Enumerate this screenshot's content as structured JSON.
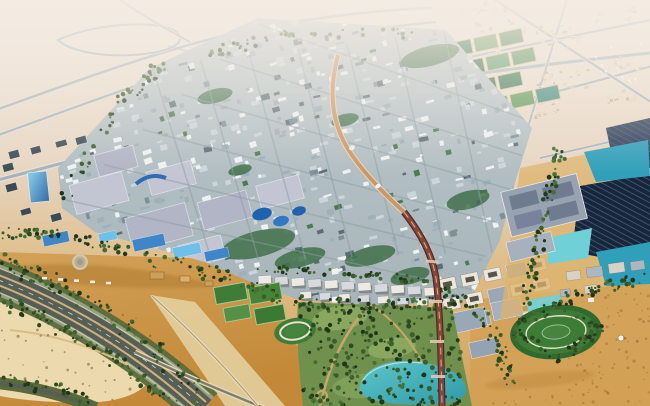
{
  "meta": {
    "description": "Aerial architectural rendering of a planned desert eco-city (Masdar-style masterplan) surrounded by sand, with a dense low-rise grid, a red elevated transit spine, solar farms, parks, sports fields, a lake and a curving tree-lined highway interchange.",
    "width": 650,
    "height": 406
  },
  "palette": {
    "haze_top": "#efe6dd",
    "sand_far": "#e7d5c0",
    "sand_mid": "#debb84",
    "sand_gold": "#d2a055",
    "sand_deep": "#c28736",
    "sand_pale_ring": "#ecd9ae",
    "sand_strip": "#e3cf9f",
    "dune_shadow": "#b07b31",
    "city_top": "#bdc9cd",
    "city_bottom": "#a7b4b9",
    "road_casing": "#eae3d8",
    "road_line": "#a6b3bc",
    "tree_band": "#5a6a3c",
    "verge": "#95a07e",
    "asphalt": "#575f55",
    "median_tan": "#cbb183",
    "lane_line": "#d9d9cb",
    "transit_upper": "#c9986a",
    "transit_upper_casing": "#ecd4ae",
    "transit_low_casing": "#4f2a22",
    "transit_low": "#86463a",
    "transit_center": "#dba57f",
    "bridge": "#dccab0",
    "solar_dark1": "#16263f",
    "solar_dark2": "#263c5f",
    "solar_patch": "#2c4366",
    "pond1": "#2f9fba",
    "pond2": "#6fd0d8",
    "lake1": "#2f9aa8",
    "lake2": "#5ec7cb",
    "azure1": "#3f86c8",
    "azure2": "#6fc0e8",
    "glass1": "#2e6da8",
    "glass2": "#8fd0ec",
    "park_base": "#70904e",
    "lawn": "#8aa75f",
    "field1": "#3f7c38",
    "field2": "#468538",
    "field3": "#549046",
    "field4": "#3a7a33",
    "field_edge": "#a9c68f",
    "track_ring": "#e6e2ca",
    "oval1": "#2f6b2f",
    "oval2": "#3c7c36",
    "oval3": "#458540",
    "path_tan": "#c8a86a",
    "slab_gray": "#9aa7b6",
    "white": "#f4f2ec",
    "dome1": "#cfc6ae",
    "dome2": "#b9ae92",
    "dome3": "#a69a7c",
    "sculpt_blue": "#1f63b0",
    "sculpt_blue2": "#2e79c4",
    "campus_dark": "#3d4a52",
    "housing_white": "#eceae2",
    "housing_gray": "#d6dade",
    "courtyard_wall": "#ece7dc",
    "courtyard_dark": "#3f3a30",
    "orange_roof": "#caa05a",
    "orange_roof2": "#d8b070"
  },
  "scene": {
    "seed": 1337,
    "city": {
      "polygon": [
        [
          62,
          208
        ],
        [
          58,
          168
        ],
        [
          150,
          68
        ],
        [
          258,
          18
        ],
        [
          446,
          30
        ],
        [
          532,
          128
        ],
        [
          514,
          186
        ],
        [
          500,
          240
        ],
        [
          470,
          300
        ],
        [
          380,
          306
        ],
        [
          300,
          300
        ],
        [
          255,
          284
        ],
        [
          205,
          262
        ],
        [
          95,
          232
        ]
      ],
      "bbox": [
        56,
        16,
        536,
        308
      ],
      "block_count": 540,
      "block_rot": -15,
      "block_colors": [
        [
          "#eef2f4",
          0.3
        ],
        [
          "#ccd6da",
          0.26
        ],
        [
          "#9fb0b8",
          0.2
        ],
        [
          "#5d6d75",
          0.12
        ],
        [
          "#7e8f98",
          0.07
        ],
        [
          "#4d7a52",
          0.05
        ]
      ]
    },
    "streets": {
      "famA": {
        "from": [
          [
            66,
            200
          ],
          [
            258,
            24
          ]
        ],
        "to": [
          [
            474,
            290
          ],
          [
            534,
            122
          ]
        ],
        "n": 6
      },
      "famB": {
        "from": [
          [
            152,
            66
          ],
          [
            444,
            32
          ]
        ],
        "to": [
          [
            212,
            262
          ],
          [
            492,
            252
          ]
        ],
        "n": 7
      },
      "color": "rgba(140,156,165,0.5)"
    },
    "green_pockets": [
      [
        258,
        244,
        38,
        13
      ],
      [
        300,
        258,
        26,
        9
      ],
      [
        430,
        56,
        30,
        10
      ],
      [
        215,
        96,
        18,
        7
      ],
      [
        468,
        200,
        22,
        9
      ],
      [
        370,
        256,
        26,
        9
      ],
      [
        160,
        220,
        20,
        8
      ],
      [
        345,
        120,
        14,
        6
      ],
      [
        240,
        170,
        12,
        5
      ],
      [
        410,
        276,
        20,
        8
      ]
    ],
    "bigbox": [
      [
        72,
        178,
        54,
        30
      ],
      [
        128,
        210,
        62,
        34
      ],
      [
        148,
        166,
        46,
        24
      ],
      [
        200,
        196,
        50,
        28
      ],
      [
        258,
        180,
        44,
        24
      ],
      [
        96,
        150,
        40,
        22
      ],
      [
        180,
        240,
        44,
        24
      ]
    ],
    "distant_clusters": [
      [
        500,
        18,
        26,
        30
      ],
      [
        560,
        36,
        20,
        24
      ],
      [
        612,
        14,
        16,
        20
      ],
      [
        478,
        50,
        14,
        18
      ],
      [
        562,
        80,
        22,
        26
      ],
      [
        626,
        62,
        14,
        16
      ],
      [
        540,
        108,
        18,
        22
      ],
      [
        618,
        96,
        12,
        16
      ],
      [
        470,
        8,
        12,
        14
      ]
    ],
    "distant_colors": [
      "#dcc6ad",
      "#e6d6c2",
      "#cdb392"
    ],
    "turbines": {
      "area": [
        592,
        40,
        56,
        42
      ],
      "n": 9
    },
    "farm": {
      "origin": [
        432,
        38
      ],
      "rot": -12,
      "cx": 480,
      "cy": 90,
      "cols": 4,
      "rows": 4,
      "stepx": 26,
      "stepy": 21,
      "w": 23,
      "h": 14,
      "colors": [
        "#3f7d4c",
        "#5d9a58",
        "#2f6d49",
        "#4f8f56",
        "#3e8a7e",
        "#6aa35f",
        "#35764f",
        "#7fbecc",
        "#549a66",
        "#417f58",
        "#4a9a8e",
        "#6fb3c0"
      ]
    },
    "tree_colors": [
      "#20351a",
      "#2c4a20",
      "#3a5f2a",
      "#476e33"
    ],
    "tree_bands": [
      {
        "path": [
          [
            150,
            258
          ],
          [
            220,
            275
          ],
          [
            300,
            303
          ],
          [
            380,
            308
          ],
          [
            460,
            300
          ]
        ],
        "n": 120,
        "spread": 7
      },
      {
        "path": [
          [
            560,
            150
          ],
          [
            548,
            200
          ],
          [
            538,
            252
          ],
          [
            526,
            300
          ]
        ],
        "n": 70,
        "spread": 6
      },
      {
        "path": [
          [
            -5,
            258
          ],
          [
            60,
            286
          ],
          [
            140,
            336
          ],
          [
            205,
            400
          ]
        ],
        "n": 95,
        "spread": 9
      },
      {
        "path": [
          [
            -5,
            296
          ],
          [
            52,
            322
          ],
          [
            126,
            366
          ],
          [
            188,
            416
          ]
        ],
        "n": 85,
        "spread": 8
      },
      {
        "path": [
          [
            512,
            330
          ],
          [
            556,
            304
          ],
          [
            600,
            330
          ],
          [
            556,
            360
          ],
          [
            512,
            330
          ]
        ],
        "n": 90,
        "spread": 5
      },
      {
        "path": [
          [
            250,
            268
          ],
          [
            430,
            280
          ]
        ],
        "n": 50,
        "spread": 4
      },
      {
        "path": [
          [
            200,
            55
          ],
          [
            300,
            32
          ],
          [
            420,
            34
          ]
        ],
        "n": 40,
        "spread": 5
      },
      {
        "path": [
          [
            62,
            198
          ],
          [
            120,
            104
          ],
          [
            166,
            62
          ]
        ],
        "n": 45,
        "spread": 6
      },
      {
        "path": [
          [
            -5,
            378
          ],
          [
            60,
            390
          ],
          [
            95,
            406
          ]
        ],
        "n": 40,
        "spread": 6
      },
      {
        "path": [
          [
            430,
            286
          ],
          [
            470,
            304
          ],
          [
            500,
            344
          ],
          [
            510,
            384
          ]
        ],
        "n": 70,
        "spread": 7
      },
      {
        "path": [
          [
            560,
            300
          ],
          [
            650,
            276
          ]
        ],
        "n": 40,
        "spread": 6
      },
      {
        "path": [
          [
            0,
            232
          ],
          [
            60,
            236
          ],
          [
            130,
            252
          ]
        ],
        "n": 55,
        "spread": 6
      }
    ],
    "park": {
      "polygon": [
        [
          298,
          302
        ],
        [
          452,
          308
        ],
        [
          472,
          406
        ],
        [
          303,
          406
        ]
      ],
      "n": 240
    },
    "scrub": {
      "polygon": [
        [
          0,
          300
        ],
        [
          150,
          318
        ],
        [
          160,
          360
        ],
        [
          120,
          400
        ],
        [
          0,
          398
        ]
      ],
      "n": 60,
      "color": "rgba(96,90,44,0.5)"
    },
    "desert_speckle": {
      "polygon": [
        [
          600,
          296
        ],
        [
          650,
          288
        ],
        [
          650,
          406
        ],
        [
          484,
          406
        ],
        [
          560,
          368
        ]
      ],
      "n": 90,
      "color": "rgba(140,95,35,0.4)"
    },
    "housing_rows": [
      {
        "from": [
          258,
          276
        ],
        "to": [
          424,
          288
        ],
        "n": 11,
        "w": 13,
        "h": 8
      },
      {
        "from": [
          300,
          292
        ],
        "to": [
          416,
          299
        ],
        "n": 7,
        "w": 11,
        "h": 7
      }
    ],
    "courtyards": {
      "origin": [
        438,
        280
      ],
      "rot": -12,
      "cols": 5,
      "rows": 3,
      "stepx": 23,
      "stepy": 20,
      "w": 17,
      "h": 12
    },
    "campus_blocks": [
      [
        8,
        152
      ],
      [
        30,
        148
      ],
      [
        55,
        142
      ],
      [
        75,
        138
      ],
      [
        5,
        185
      ],
      [
        20,
        210
      ],
      [
        50,
        215
      ],
      [
        2,
        165
      ]
    ],
    "pond_row": [
      [
        42,
        236,
        26,
        11
      ],
      [
        98,
        234,
        18,
        9
      ],
      [
        132,
        240,
        32,
        12
      ],
      [
        172,
        248,
        28,
        11
      ],
      [
        204,
        252,
        24,
        10
      ]
    ]
  }
}
